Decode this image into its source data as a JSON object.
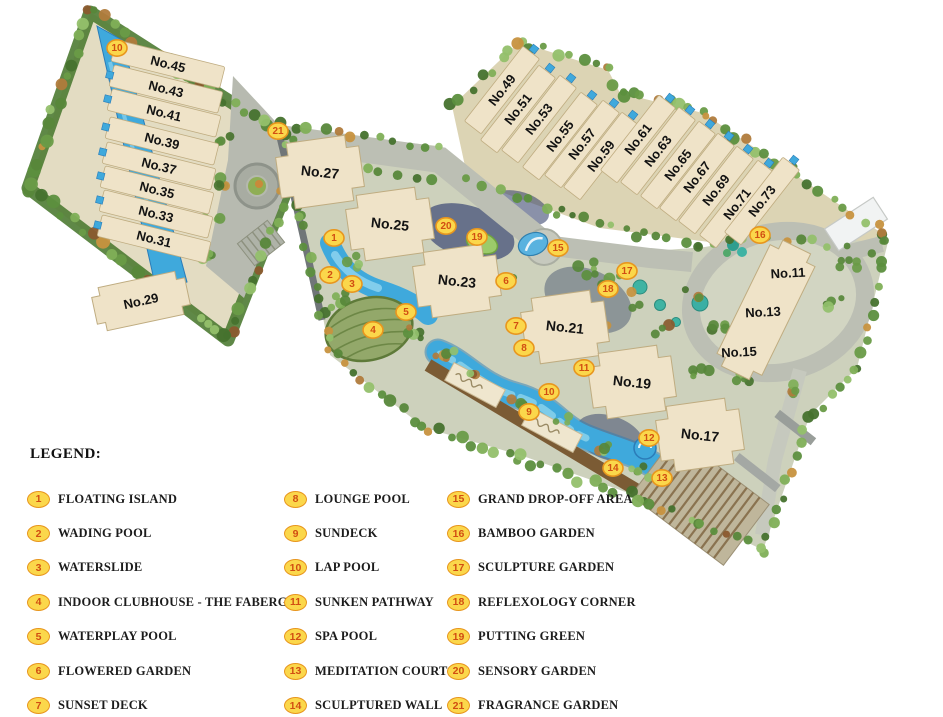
{
  "legend": {
    "title": "LEGEND:",
    "columns": [
      {
        "items": [
          {
            "num": "1",
            "label": "FLOATING ISLAND"
          },
          {
            "num": "2",
            "label": "WADING POOL"
          },
          {
            "num": "3",
            "label": "WATERSLIDE"
          },
          {
            "num": "4",
            "label": "INDOOR CLUBHOUSE - THE FABERGÈ"
          },
          {
            "num": "5",
            "label": "WATERPLAY POOL"
          },
          {
            "num": "6",
            "label": "FLOWERED GARDEN"
          },
          {
            "num": "7",
            "label": "SUNSET DECK"
          }
        ]
      },
      {
        "items": [
          {
            "num": "8",
            "label": "LOUNGE POOL"
          },
          {
            "num": "9",
            "label": "SUNDECK"
          },
          {
            "num": "10",
            "label": "LAP POOL"
          },
          {
            "num": "11",
            "label": "SUNKEN PATHWAY"
          },
          {
            "num": "12",
            "label": "SPA POOL"
          },
          {
            "num": "13",
            "label": "MEDITATION COURT"
          },
          {
            "num": "14",
            "label": "SCULPTURED WALL"
          }
        ]
      },
      {
        "items": [
          {
            "num": "15",
            "label": "GRAND DROP-OFF AREA"
          },
          {
            "num": "16",
            "label": "BAMBOO GARDEN"
          },
          {
            "num": "17",
            "label": "SCULPTURE GARDEN"
          },
          {
            "num": "18",
            "label": "REFLEXOLOGY CORNER"
          },
          {
            "num": "19",
            "label": "PUTTING GREEN"
          },
          {
            "num": "20",
            "label": "SENSORY GARDEN"
          },
          {
            "num": "21",
            "label": "FRAGRANCE GARDEN"
          }
        ]
      }
    ]
  },
  "map": {
    "buildings": [
      {
        "label": "No.45",
        "x": 168,
        "y": 64,
        "rot": 14,
        "area": "left-strip"
      },
      {
        "label": "No.43",
        "x": 166,
        "y": 89,
        "rot": 14,
        "area": "left-strip"
      },
      {
        "label": "No.41",
        "x": 164,
        "y": 113,
        "rot": 14,
        "area": "left-strip"
      },
      {
        "label": "No.39",
        "x": 162,
        "y": 141,
        "rot": 14,
        "area": "left-strip"
      },
      {
        "label": "No.37",
        "x": 159,
        "y": 166,
        "rot": 14,
        "area": "left-strip"
      },
      {
        "label": "No.35",
        "x": 157,
        "y": 190,
        "rot": 14,
        "area": "left-strip"
      },
      {
        "label": "No.33",
        "x": 156,
        "y": 214,
        "rot": 14,
        "area": "left-strip"
      },
      {
        "label": "No.31",
        "x": 154,
        "y": 239,
        "rot": 14,
        "area": "left-strip"
      },
      {
        "label": "No.29",
        "x": 141,
        "y": 301,
        "rot": -12,
        "area": "left-block"
      },
      {
        "label": "No.27",
        "x": 320,
        "y": 172,
        "rot": 6,
        "area": "central"
      },
      {
        "label": "No.25",
        "x": 390,
        "y": 224,
        "rot": 6,
        "area": "central"
      },
      {
        "label": "No.23",
        "x": 457,
        "y": 281,
        "rot": 6,
        "area": "central"
      },
      {
        "label": "No.21",
        "x": 565,
        "y": 327,
        "rot": 6,
        "area": "central"
      },
      {
        "label": "No.19",
        "x": 632,
        "y": 382,
        "rot": 6,
        "area": "central"
      },
      {
        "label": "No.17",
        "x": 700,
        "y": 435,
        "rot": 6,
        "area": "central"
      },
      {
        "label": "No.49",
        "x": 502,
        "y": 90,
        "rot": -52,
        "area": "tr-strip"
      },
      {
        "label": "No.51",
        "x": 518,
        "y": 109,
        "rot": -52,
        "area": "tr-strip"
      },
      {
        "label": "No.53",
        "x": 539,
        "y": 119,
        "rot": -52,
        "area": "tr-strip"
      },
      {
        "label": "No.55",
        "x": 560,
        "y": 136,
        "rot": -52,
        "area": "tr-strip"
      },
      {
        "label": "No.57",
        "x": 582,
        "y": 144,
        "rot": -52,
        "area": "tr-strip"
      },
      {
        "label": "No.59",
        "x": 601,
        "y": 156,
        "rot": -52,
        "area": "tr-strip"
      },
      {
        "label": "No.61",
        "x": 638,
        "y": 139,
        "rot": -52,
        "area": "tr-strip"
      },
      {
        "label": "No.63",
        "x": 658,
        "y": 151,
        "rot": -52,
        "area": "tr-strip"
      },
      {
        "label": "No.65",
        "x": 678,
        "y": 165,
        "rot": -52,
        "area": "tr-strip"
      },
      {
        "label": "No.67",
        "x": 697,
        "y": 177,
        "rot": -52,
        "area": "tr-strip"
      },
      {
        "label": "No.69",
        "x": 716,
        "y": 190,
        "rot": -52,
        "area": "tr-strip"
      },
      {
        "label": "No.71",
        "x": 737,
        "y": 204,
        "rot": -52,
        "area": "tr-strip"
      },
      {
        "label": "No.73",
        "x": 762,
        "y": 201,
        "rot": -52,
        "area": "tr-strip"
      },
      {
        "label": "No.11",
        "x": 788,
        "y": 273,
        "rot": -3,
        "area": "right"
      },
      {
        "label": "No.13",
        "x": 763,
        "y": 312,
        "rot": -3,
        "area": "right"
      },
      {
        "label": "No.15",
        "x": 739,
        "y": 352,
        "rot": -3,
        "area": "right"
      }
    ],
    "markers": [
      {
        "num": "10",
        "x": 117,
        "y": 48
      },
      {
        "num": "21",
        "x": 278,
        "y": 131
      },
      {
        "num": "1",
        "x": 334,
        "y": 238
      },
      {
        "num": "2",
        "x": 330,
        "y": 275
      },
      {
        "num": "3",
        "x": 352,
        "y": 284
      },
      {
        "num": "4",
        "x": 373,
        "y": 330
      },
      {
        "num": "5",
        "x": 406,
        "y": 312
      },
      {
        "num": "20",
        "x": 446,
        "y": 226
      },
      {
        "num": "19",
        "x": 477,
        "y": 237
      },
      {
        "num": "6",
        "x": 506,
        "y": 281
      },
      {
        "num": "15",
        "x": 558,
        "y": 248
      },
      {
        "num": "17",
        "x": 627,
        "y": 271
      },
      {
        "num": "18",
        "x": 608,
        "y": 289
      },
      {
        "num": "7",
        "x": 516,
        "y": 326
      },
      {
        "num": "8",
        "x": 524,
        "y": 348
      },
      {
        "num": "11",
        "x": 584,
        "y": 368
      },
      {
        "num": "10",
        "x": 549,
        "y": 392
      },
      {
        "num": "9",
        "x": 529,
        "y": 412
      },
      {
        "num": "12",
        "x": 649,
        "y": 438
      },
      {
        "num": "14",
        "x": 613,
        "y": 468
      },
      {
        "num": "13",
        "x": 662,
        "y": 478
      },
      {
        "num": "16",
        "x": 760,
        "y": 235
      }
    ],
    "colors": {
      "water": "#3FA9DC",
      "water_deep": "#2B7CB8",
      "water_light": "#8ED4EE",
      "building_fill": "#EFE3C8",
      "building_edge": "#BFAC80",
      "ground": "#DCD5BA",
      "road": "#BCBFB4",
      "road_dark": "#6E7475",
      "tree_green": "#57873A",
      "deck_brown": "#7B5B34",
      "dome_green": "#93A86A",
      "badge_fill": "#FBD74B",
      "badge_ring": "#E8961E",
      "badge_number": "#D14E12",
      "label_color": "#121212",
      "legend_text": "#1C1C1C"
    }
  }
}
